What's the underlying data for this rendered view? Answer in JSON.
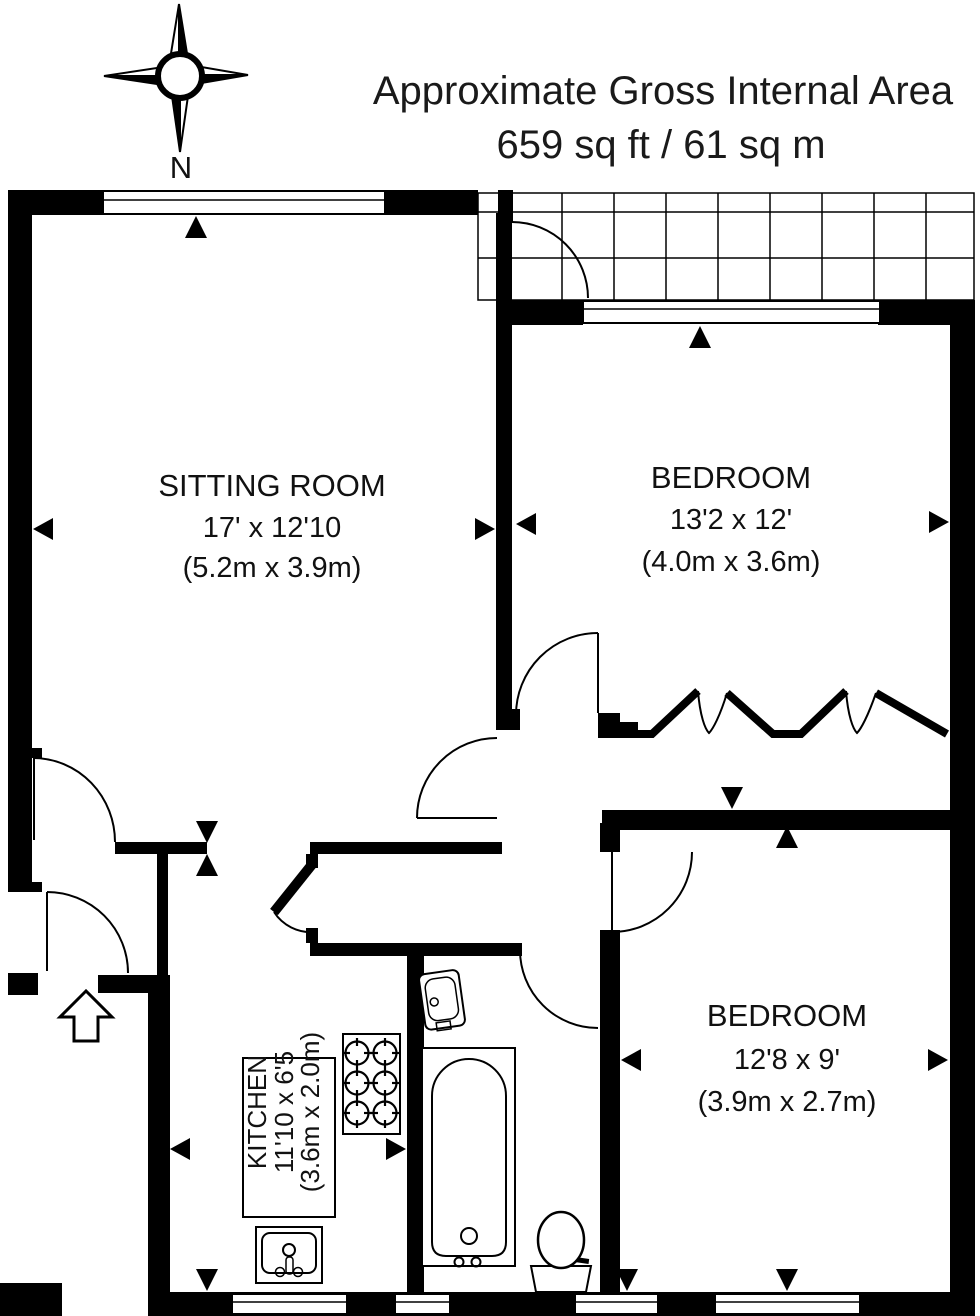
{
  "header": {
    "title_line1": "Approximate Gross Internal Area",
    "title_line2": "659 sq ft / 61 sq m"
  },
  "compass": {
    "label": "N"
  },
  "rooms": {
    "sitting_room": {
      "name": "SITTING ROOM",
      "dimensions_imperial": "17' x 12'10",
      "dimensions_metric": "(5.2m x 3.9m)"
    },
    "bedroom_1": {
      "name": "BEDROOM",
      "dimensions_imperial": "13'2 x 12'",
      "dimensions_metric": "(4.0m x 3.6m)"
    },
    "bedroom_2": {
      "name": "BEDROOM",
      "dimensions_imperial": "12'8 x 9'",
      "dimensions_metric": "(3.9m x 2.7m)"
    },
    "kitchen": {
      "name": "KITCHEN",
      "dimensions_imperial": "11'10 x 6'5",
      "dimensions_metric": "(3.6m x 2.0m)"
    }
  },
  "colors": {
    "wall": "#000000",
    "background": "#ffffff",
    "line": "#000000"
  }
}
